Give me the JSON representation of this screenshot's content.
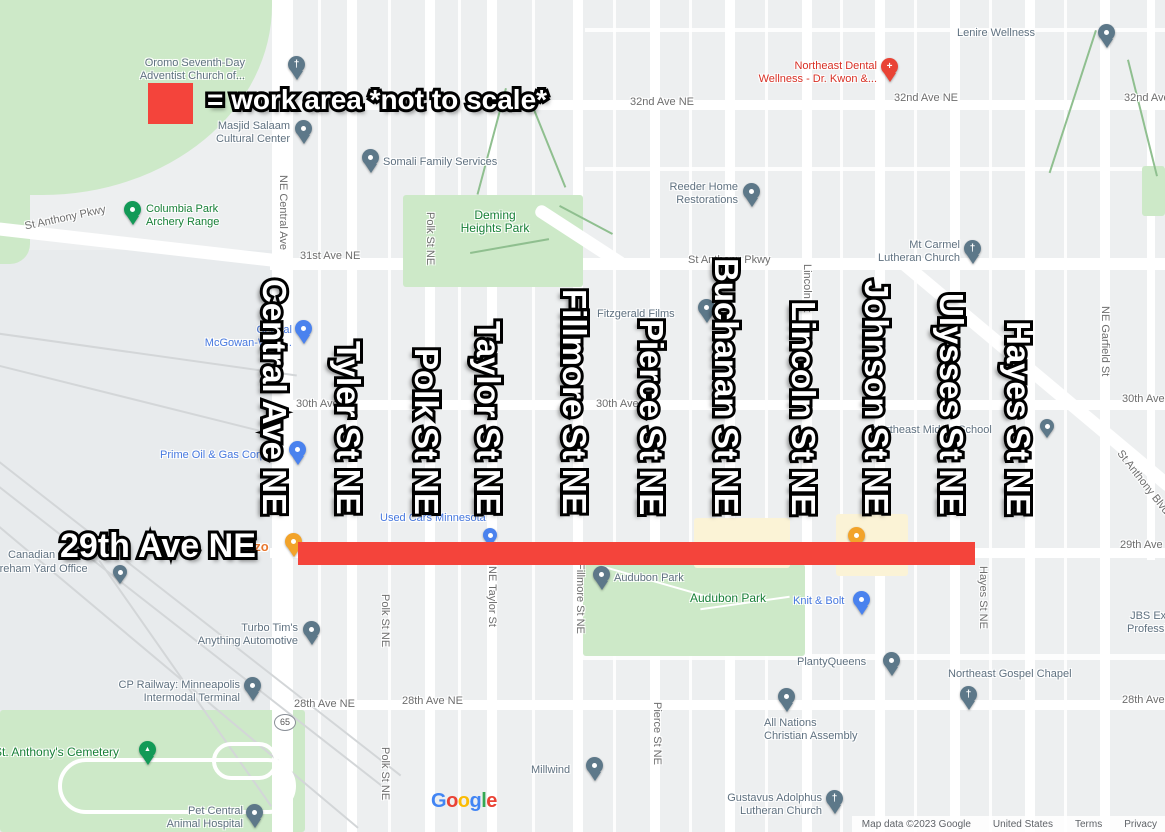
{
  "palette": {
    "work_red": "#f4443b",
    "park_green": "#cde9c8",
    "commercial_beige": "#fbf3d6",
    "poi_slate": "#5f7180",
    "poi_blue": "#4678df",
    "poi_red": "#d93025",
    "poi_green": "#188038",
    "poi_orange": "#e8772e",
    "pin_slate": "#5d7889",
    "pin_blue": "#4a82ee",
    "pin_green": "#129a57",
    "pin_red": "#e94335",
    "pin_orange": "#f2a32a",
    "road_label_gray": "#6e6e6e"
  },
  "legend": {
    "label": "= work area *not to scale*"
  },
  "overlay": {
    "avenue": "29th Ave NE",
    "streets": [
      "Central Ave NE",
      "Tyler St NE",
      "Polk St NE",
      "Taylor St NE",
      "Fillmore St NE",
      "Pierce St NE",
      "Buchanan St NE",
      "Lincoln St NE",
      "Johnson St NE",
      "Ulysses St NE",
      "Hayes St NE"
    ]
  },
  "shield": {
    "route": "65"
  },
  "icons": {
    "church": "†",
    "dental": "+",
    "tree": "▲"
  },
  "road_labels": {
    "ave32_a": "32nd Ave NE",
    "ave32_b": "32nd Ave NE",
    "ave32_c": "32nd Ave NE",
    "ave31": "31st Ave NE",
    "pkwy_a": "St Anthony Pkwy",
    "pkwy_b": "St Anthony Pkwy",
    "ave30_a": "30th Ave NE",
    "ave30_b": "30th Ave NE",
    "ave30_c": "30th Ave NE",
    "ave29_a": "29th Ave NE",
    "ave29_b": "29th Ave NE",
    "ave28_a": "28th Ave NE",
    "ave28_b": "28th Ave NE",
    "ave28_c": "28th Ave NE",
    "blvd": "St Anthony Blvd"
  },
  "street_labels": {
    "central": "NE Central Ave",
    "polk_top": "Polk St NE",
    "lincoln": "Lincoln St",
    "garfield": "NE Garfield St",
    "polk_mid": "Polk St NE",
    "taylor": "NE Taylor St",
    "fillmore": "Fillmore St NE",
    "hayes": "Hayes St NE",
    "pierce": "Pierce St NE",
    "polk_bot": "Polk St NE"
  },
  "pois": {
    "oromo": {
      "line1": "Oromo Seventh-Day",
      "line2": "Adventist Church of..."
    },
    "masjid": {
      "line1": "Masjid Salaam",
      "line2": "Cultural Center"
    },
    "somali": {
      "line1": "Somali Family Services"
    },
    "dental": {
      "line1": "Northeast Dental",
      "line2": "Wellness - Dr. Kwon &..."
    },
    "lenire": {
      "line1": "Lenire Wellness"
    },
    "archery": {
      "line1": "Columbia Park",
      "line2": "Archery Range"
    },
    "reeder": {
      "line1": "Reeder Home",
      "line2": "Restorations"
    },
    "mtcarmel": {
      "line1": "Mt Carmel",
      "line2": "Lutheran Church"
    },
    "fitzgerald": {
      "line1": "Fitzgerald Films"
    },
    "mcgowan": {
      "line1": "Central",
      "line2": "McGowan-Weld..."
    },
    "prime": {
      "line1": "Prime Oil & Gas Corp"
    },
    "usedcars": {
      "line1": "Used Cars Minnesota"
    },
    "azo": {
      "line1": "azo"
    },
    "audubon_pin": {
      "line1": "Audubon Park"
    },
    "audubon_area": {
      "line1": "Audubon Park"
    },
    "knit": {
      "line1": "Knit & Bolt"
    },
    "school": {
      "line1": "Northeast Middle School"
    },
    "planty": {
      "line1": "PlantyQueens"
    },
    "gospel": {
      "line1": "Northeast Gospel Chapel"
    },
    "allnations": {
      "line1": "All Nations",
      "line2": "Christian Assembly"
    },
    "gustavus": {
      "line1": "Gustavus Adolphus",
      "line2": "Lutheran Church"
    },
    "millwind": {
      "line1": "Millwind"
    },
    "turbo": {
      "line1": "Turbo Tim's",
      "line2": "Anything Automotive"
    },
    "cprail": {
      "line1": "CP Railway: Minneapolis",
      "line2": "Intermodal Terminal"
    },
    "cemetery": {
      "line1": "St. Anthony's Cemetery"
    },
    "petcentral": {
      "line1": "Pet Central",
      "line2": "Animal Hospital"
    },
    "jbs": {
      "line1": "JBS Exter",
      "line2": "Profession"
    },
    "yard": {
      "line1": "Canadian",
      "line2": "Shoreham Yard Office"
    },
    "deming": {
      "line1": "Deming",
      "line2": "Heights Park"
    }
  },
  "google": {
    "letters": [
      "G",
      "o",
      "o",
      "g",
      "l",
      "e"
    ]
  },
  "attribution": {
    "mapdata": "Map data ©2023 Google",
    "country": "United States",
    "terms": "Terms",
    "privacy": "Privacy"
  }
}
